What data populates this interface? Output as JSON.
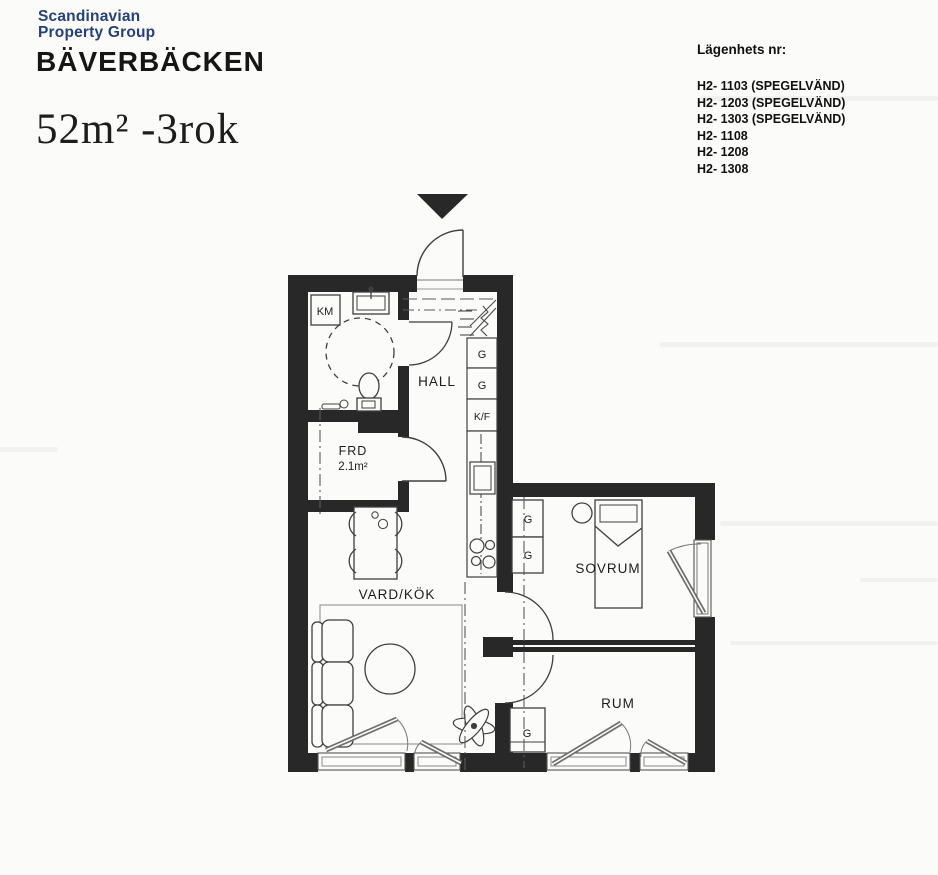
{
  "header": {
    "logo_line1": "Scandinavian",
    "logo_line2": "Property Group",
    "project_name": "BÄVERBÄCKEN",
    "size_label": "52m² -3rok"
  },
  "apartments": {
    "title": "Lägenhets nr:",
    "items": [
      "H2- 1103 (SPEGELVÄND)",
      "H2- 1203 (SPEGELVÄND)",
      "H2- 1303 (SPEGELVÄND)",
      "H2- 1108",
      "H2- 1208",
      "H2- 1308"
    ]
  },
  "plan": {
    "rooms": {
      "hall": "HALL",
      "frd": "FRD",
      "frd_area": "2.1m²",
      "vardkok": "VARD/KÖK",
      "sovrum": "SOVRUM",
      "rum": "RUM"
    },
    "fixtures": {
      "km": "KM",
      "g": "G",
      "kf": "K/F"
    }
  },
  "colors": {
    "logo_navy": "#25417a",
    "wall": "#282828",
    "paper": "#fbfbf9",
    "thin_line": "#3f3f3f"
  }
}
